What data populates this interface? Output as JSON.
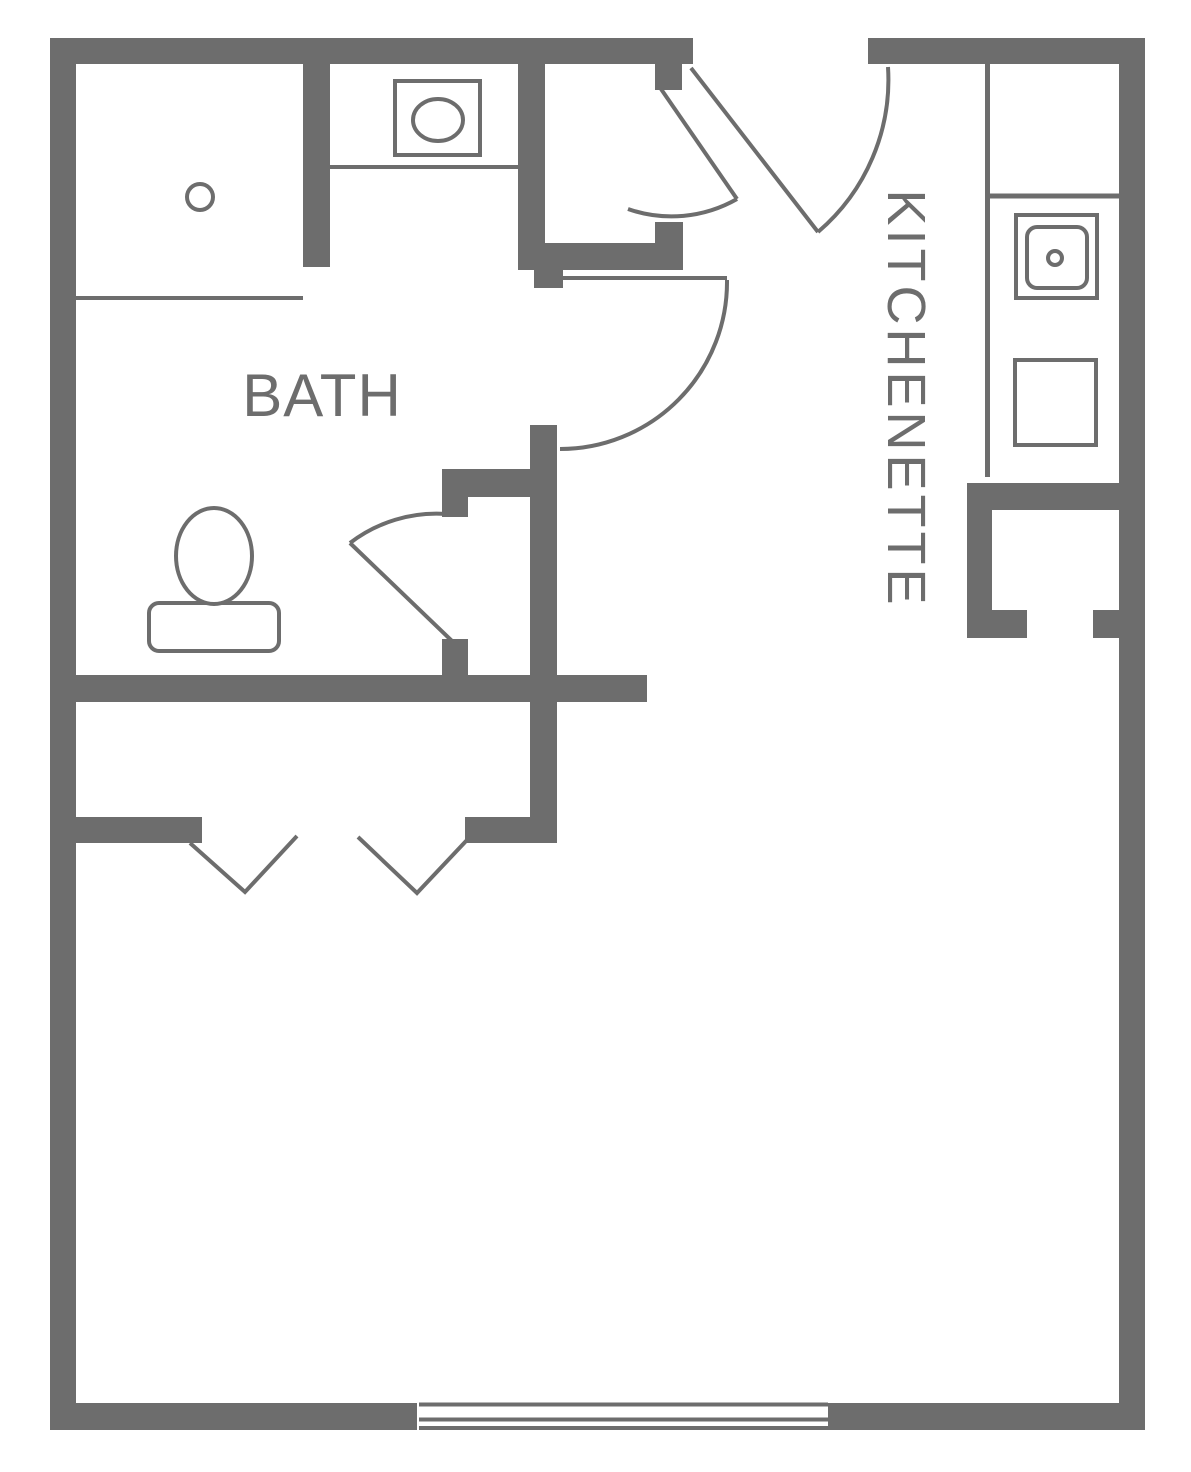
{
  "labels": {
    "bath": "BATH",
    "kitchenette": "KITCHENETTE"
  },
  "colors": {
    "wall": "#6d6d6d",
    "line": "#6d6d6d",
    "text": "#6d6d6d",
    "background": "#ffffff"
  },
  "rooms": [
    {
      "name": "bath",
      "label": "BATH"
    },
    {
      "name": "kitchenette",
      "label": "KITCHENETTE"
    }
  ],
  "fixtures": [
    "shower",
    "bathroom-sink",
    "toilet",
    "kitchen-sink",
    "stove"
  ],
  "doors": [
    "entry-door",
    "closet-door",
    "bath-door",
    "bathroom-inner-door",
    "bifold-closet-doors"
  ],
  "windows": [
    "main-room-window"
  ]
}
